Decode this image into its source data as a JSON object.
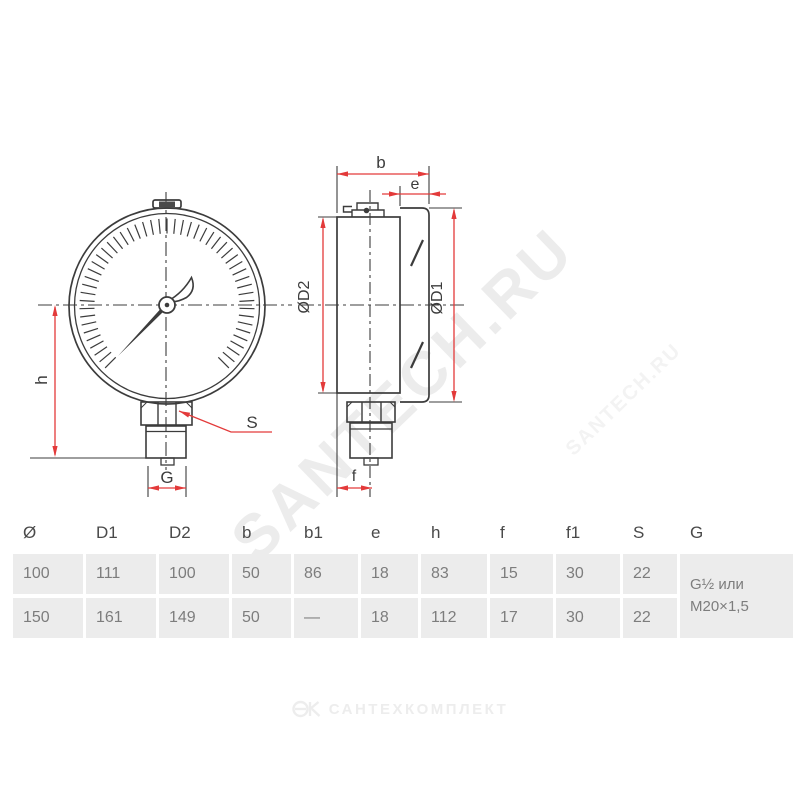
{
  "watermark": {
    "text_big": "SANTECH.RU",
    "text_small": "SANTECH.RU"
  },
  "drawing": {
    "line_color": "#3c3c3c",
    "dim_color": "#e33a3a",
    "labels": {
      "h": "h",
      "g": "G",
      "s": "S",
      "b": "b",
      "e": "e",
      "f": "f",
      "d1": "ØD1",
      "d2": "ØD2"
    }
  },
  "table": {
    "headers": [
      "Ø",
      "D1",
      "D2",
      "b",
      "b1",
      "e",
      "h",
      "f",
      "f1",
      "S",
      "G"
    ],
    "rows": [
      [
        "100",
        "111",
        "100",
        "50",
        "86",
        "18",
        "83",
        "15",
        "30",
        "22"
      ],
      [
        "150",
        "161",
        "149",
        "50",
        "—",
        "18",
        "112",
        "17",
        "30",
        "22"
      ]
    ],
    "g_value_line1": "G½ или",
    "g_value_line2": "M20×1,5"
  },
  "footer": {
    "brand": "САНТЕХКОМПЛЕКТ"
  }
}
